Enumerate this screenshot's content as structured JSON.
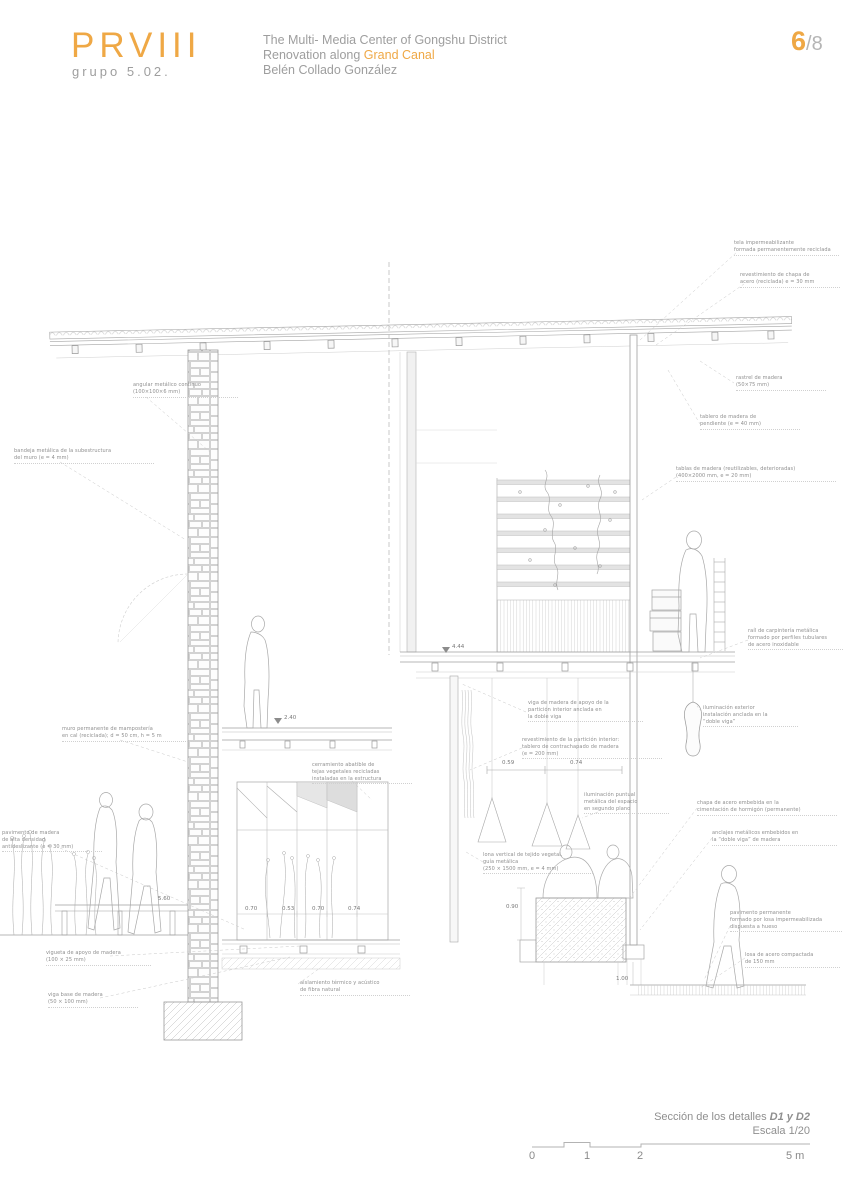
{
  "header": {
    "logo": "PRVIII",
    "group": "grupo 5.02.",
    "title_line1": "The Multi- Media Center of Gongshu District",
    "title_line2_prefix": "Renovation along ",
    "title_line2_highlight": "Grand Canal",
    "author": "Belén Collado González",
    "page_current": "6",
    "page_total": "/8"
  },
  "titleblock": {
    "caption_prefix": "Sección de los detalles ",
    "caption_bold": "D1 y D2",
    "scale_label": "Escala 1/20",
    "scalebar_ticks": [
      {
        "label": "0",
        "x": 529
      },
      {
        "label": "1",
        "x": 584
      },
      {
        "label": "2",
        "x": 637
      },
      {
        "label": "5 m",
        "x": 786
      }
    ]
  },
  "colors": {
    "accent": "#EFA845",
    "text_gray": "#9e9e9e",
    "pencil": "#ababab"
  },
  "drawing": {
    "annotations": [
      {
        "text": "tela impermeabilizante\nformada permanentemente reciclada",
        "x": 734,
        "y": 240,
        "w": 105
      },
      {
        "text": "revestimiento de chapa de\nacero (reciclada) e = 30 mm",
        "x": 740,
        "y": 272,
        "w": 100
      },
      {
        "text": "rastrel de madera\n(50×75 mm)",
        "x": 736,
        "y": 375,
        "w": 90
      },
      {
        "text": "tablero de madera de\npendiente (e = 40 mm)",
        "x": 700,
        "y": 414,
        "w": 100
      },
      {
        "text": "tablas de madera (reutilizables, deterioradas)\n(400×2000 mm, e = 20 mm)",
        "x": 676,
        "y": 466,
        "w": 160
      },
      {
        "text": "angular metálico continuo\n(100×100×6 mm)",
        "x": 133,
        "y": 382,
        "w": 105
      },
      {
        "text": "bandeja metálica de la subestructura\ndel muro (e = 4 mm)",
        "x": 14,
        "y": 448,
        "w": 140
      },
      {
        "text": "muro permanente de mampostería\nen cal (reciclada); d = 50 cm, h = 5 m",
        "x": 62,
        "y": 726,
        "w": 140
      },
      {
        "text": "cerramiento abatible de\ntejas vegetales recicladas\ninstaladas en la estructura",
        "x": 312,
        "y": 762,
        "w": 100
      },
      {
        "text": "viga de madera de apoyo de la\npartición interior anclada en\nla doble viga",
        "x": 528,
        "y": 700,
        "w": 115
      },
      {
        "text": "revestimiento de la partición interior:\ntablero de contrachapado de madera\n(e = 200 mm)",
        "x": 522,
        "y": 737,
        "w": 140
      },
      {
        "text": "iluminación puntual\nmetálica del espacio\nen segundo plano",
        "x": 584,
        "y": 792,
        "w": 85
      },
      {
        "text": "lona vertical de tejido vegetal,\nguía metálica\n(250 × 1500 mm, e = 4 mm)",
        "x": 483,
        "y": 852,
        "w": 110
      },
      {
        "text": "raíl de carpintería metálica\nformado por perfiles tubulares\nde acero inoxidable",
        "x": 748,
        "y": 628,
        "w": 95
      },
      {
        "text": "iluminación exterior\ninstalación anclada en la\n“doble viga”",
        "x": 703,
        "y": 705,
        "w": 95
      },
      {
        "text": "chapa de acero embebida en la\ncimentación de hormigón (permanente)",
        "x": 697,
        "y": 800,
        "w": 140
      },
      {
        "text": "anclajes metálicos embebidos en\nla “doble viga” de madera",
        "x": 712,
        "y": 830,
        "w": 125
      },
      {
        "text": "pavimento de madera\nde alta densidad\nantideslizante (e = 30 mm)",
        "x": 2,
        "y": 830,
        "w": 100
      },
      {
        "text": "vigueta de apoyo de madera\n(100 × 25 mm)",
        "x": 46,
        "y": 950,
        "w": 105
      },
      {
        "text": "viga base de madera\n(50 × 100 mm)",
        "x": 48,
        "y": 992,
        "w": 90
      },
      {
        "text": "pavimento permanente\nformado por losa impermeabilizada\ndispuesta a hueso",
        "x": 730,
        "y": 910,
        "w": 112
      },
      {
        "text": "losa de acero compactada\nde 150 mm",
        "x": 745,
        "y": 952,
        "w": 95
      },
      {
        "text": "aislamiento térmico y acústico\nde fibra natural",
        "x": 300,
        "y": 980,
        "w": 110
      }
    ],
    "dimensions": [
      {
        "t": "2.40",
        "x": 284,
        "y": 715
      },
      {
        "t": "4.44",
        "x": 452,
        "y": 644
      },
      {
        "t": "0.59",
        "x": 502,
        "y": 760
      },
      {
        "t": "0.74",
        "x": 570,
        "y": 760
      },
      {
        "t": "0.70",
        "x": 245,
        "y": 906
      },
      {
        "t": "0.53",
        "x": 282,
        "y": 906
      },
      {
        "t": "0.70",
        "x": 312,
        "y": 906
      },
      {
        "t": "0.74",
        "x": 348,
        "y": 906
      },
      {
        "t": "0.90",
        "x": 506,
        "y": 904
      },
      {
        "t": "1.00",
        "x": 616,
        "y": 976
      },
      {
        "t": "5.60",
        "x": 158,
        "y": 896
      }
    ]
  }
}
